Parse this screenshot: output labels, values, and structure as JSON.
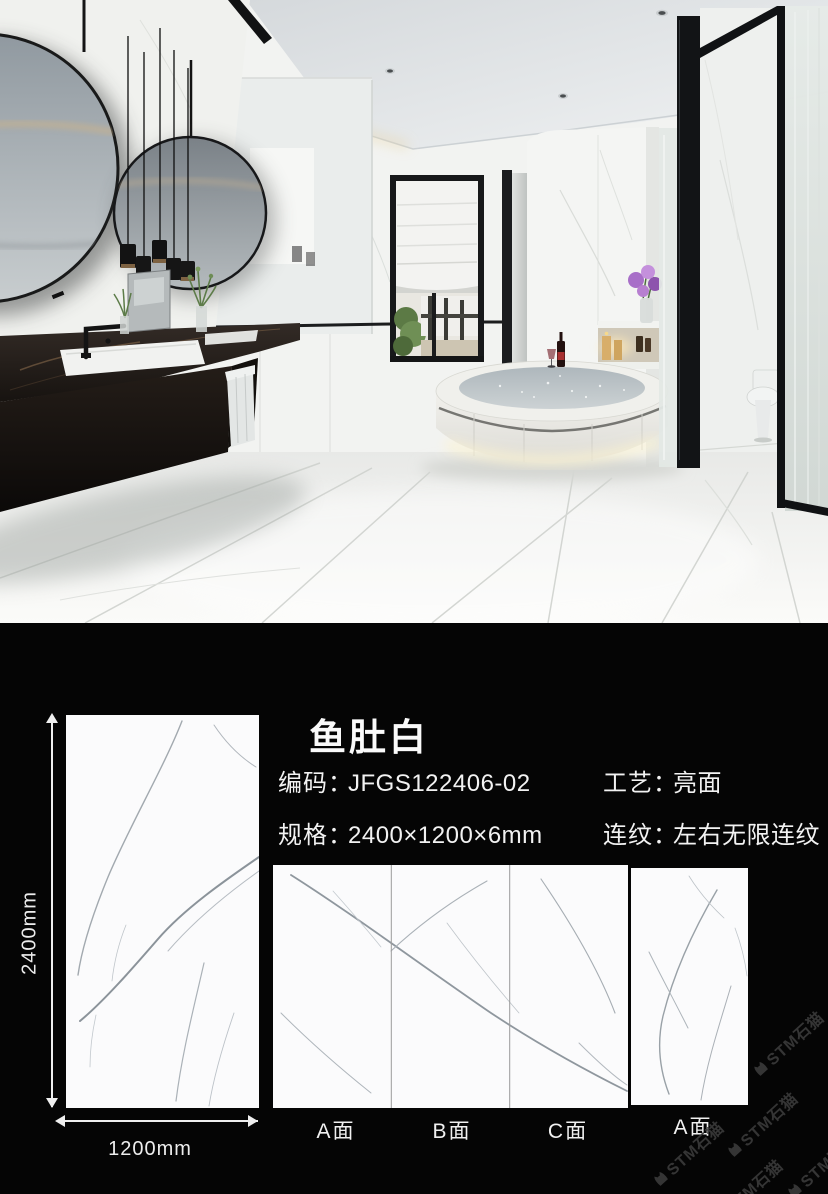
{
  "product": {
    "title": "鱼肚白",
    "code": {
      "label": "编码：",
      "value": "JFGS122406-02"
    },
    "finish": {
      "label": "工艺：",
      "value": "亮面"
    },
    "size": {
      "label": "规格：",
      "value": "2400×1200×6mm"
    },
    "pattern": {
      "label": "连纹：",
      "value": "左右无限连纹"
    }
  },
  "dimensions": {
    "height": "2400mm",
    "width": "1200mm"
  },
  "tiles": {
    "group": [
      {
        "label": "A面"
      },
      {
        "label": "B面"
      },
      {
        "label": "C面"
      }
    ],
    "single": {
      "label": "A面"
    }
  },
  "watermark": {
    "text": "STM石猫"
  },
  "colors": {
    "section_bg": "#050505",
    "text": "#f2f2f2",
    "tile": "#fbfbfc",
    "watermark": "#3a3a3a"
  }
}
